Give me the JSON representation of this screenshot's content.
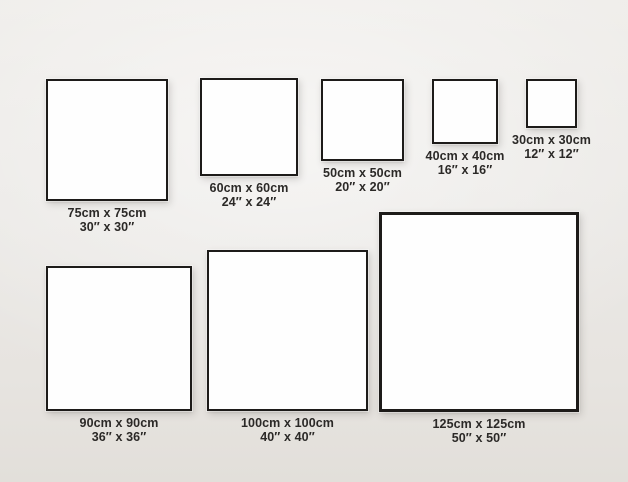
{
  "page": {
    "description": "Square canvas size comparison chart",
    "colors": {
      "wall_background": "#eae8e5",
      "frame_fill": "#fefefe",
      "frame_border": "#1d1b19",
      "label_text": "#2b2927"
    }
  },
  "sizes": [
    {
      "id": "75",
      "cm": 75,
      "inches": 30,
      "cm_label": "75cm x 75cm",
      "inch_label": "30″ x 30″"
    },
    {
      "id": "60",
      "cm": 60,
      "inches": 24,
      "cm_label": "60cm x 60cm",
      "inch_label": "24″ x 24″"
    },
    {
      "id": "50",
      "cm": 50,
      "inches": 20,
      "cm_label": "50cm x 50cm",
      "inch_label": "20″ x 20″"
    },
    {
      "id": "40",
      "cm": 40,
      "inches": 16,
      "cm_label": "40cm x 40cm",
      "inch_label": "16″ x 16″"
    },
    {
      "id": "30",
      "cm": 30,
      "inches": 12,
      "cm_label": "30cm x 30cm",
      "inch_label": "12″ x 12″"
    },
    {
      "id": "90",
      "cm": 90,
      "inches": 36,
      "cm_label": "90cm x 90cm",
      "inch_label": "36″ x 36″"
    },
    {
      "id": "100",
      "cm": 100,
      "inches": 40,
      "cm_label": "100cm x 100cm",
      "inch_label": "40″ x 40″"
    },
    {
      "id": "125",
      "cm": 125,
      "inches": 50,
      "cm_label": "125cm x 125cm",
      "inch_label": "50″ x 50″"
    }
  ]
}
